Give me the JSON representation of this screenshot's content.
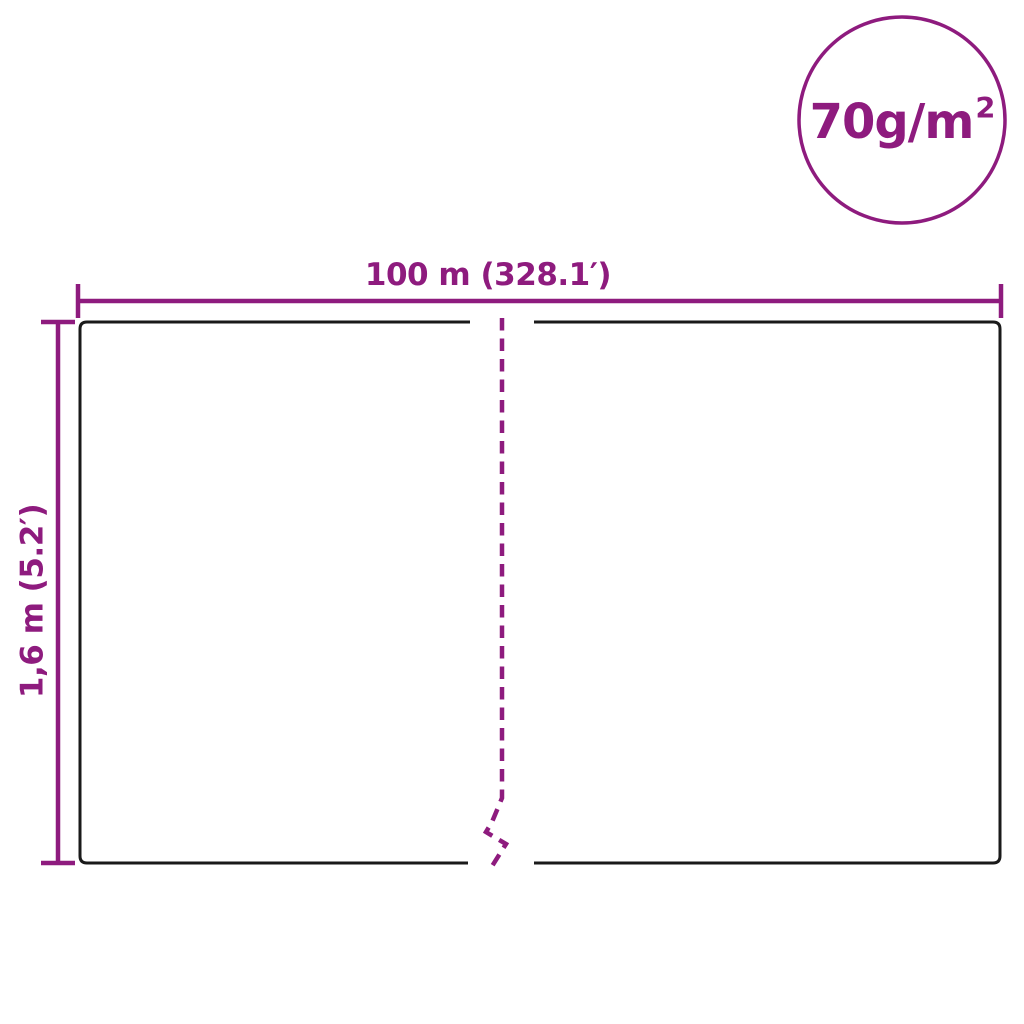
{
  "colors": {
    "accent": "#8E1B7E",
    "outline": "#1A1A1A",
    "background": "#FFFFFF"
  },
  "diagram": {
    "width_label": "100 m (328.1′)",
    "height_label": "1,6 m (5.2′)",
    "weight_main": "70g/m",
    "weight_sup": "2"
  }
}
